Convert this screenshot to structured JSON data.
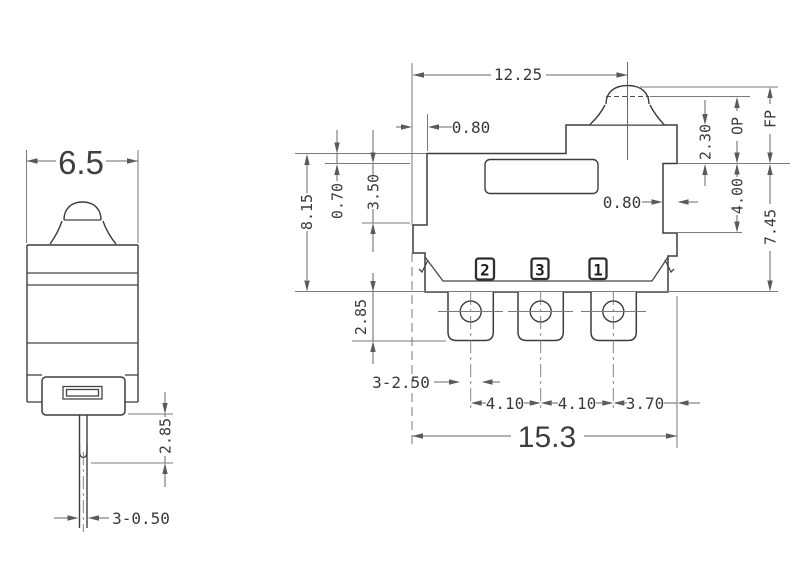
{
  "title": "Micro switch dimensional drawing",
  "colors": {
    "outline": "#3d3d3d",
    "dimension": "#666666",
    "text": "#3a3a3a",
    "background": "#ffffff"
  },
  "front_view": {
    "body_width": "6.5",
    "pin_exposed_length": "2.85",
    "pin_width": "3-0.50"
  },
  "side_view": {
    "plunger_center_offset": "12.25",
    "mount_step_width": "0.80",
    "top_step_height": "0.70",
    "upper_body_height": "3.50",
    "body_height": "8.15",
    "button_height": "2.30",
    "operating_position": "OP",
    "free_position": "FP",
    "side_step_height": "4.00",
    "total_height_to_fp": "7.45",
    "side_step_width": "0.80",
    "terminal_length": "2.85",
    "terminal_holes": "3-2.50",
    "terminal_pitch_left": "4.10",
    "terminal_pitch_right": "4.10",
    "terminal_edge_offset": "3.70",
    "total_width": "15.3",
    "terminal_numbers": [
      "2",
      "3",
      "1"
    ]
  }
}
